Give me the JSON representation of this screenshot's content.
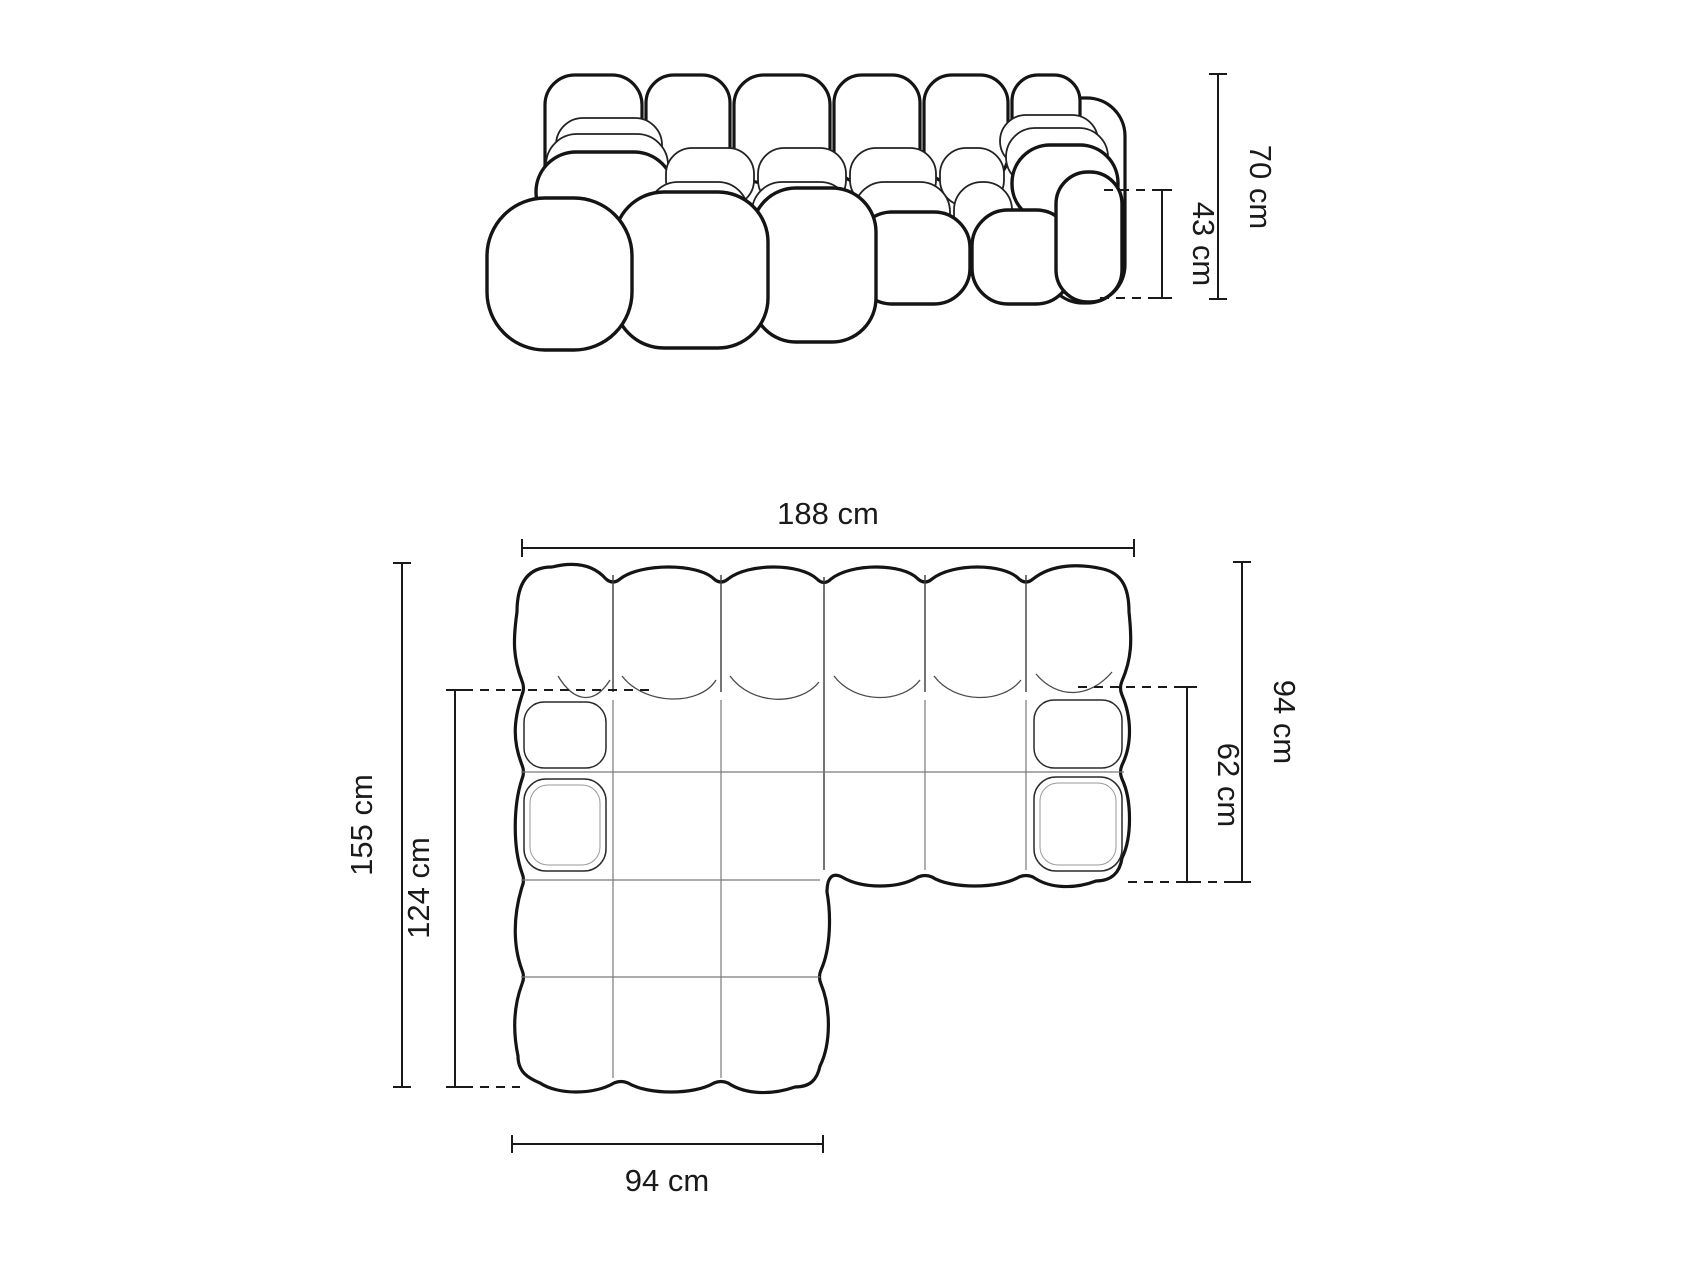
{
  "diagram": {
    "subject": "modular-corner-sofa-dimension-drawing",
    "front_view": {
      "total_height": "70 cm",
      "seat_height": "43 cm"
    },
    "top_view": {
      "total_width": "188 cm",
      "total_depth": "155 cm",
      "chaise_inner_depth": "124 cm",
      "chaise_width": "94 cm",
      "right_section_depth": "94 cm",
      "seat_depth": "62 cm"
    },
    "colors": {
      "background": "#ffffff",
      "outline": "#141414",
      "seam_light": "#7a7a7a",
      "dimension_line": "#1a1a1a",
      "label_text": "#1a1a1a"
    }
  }
}
